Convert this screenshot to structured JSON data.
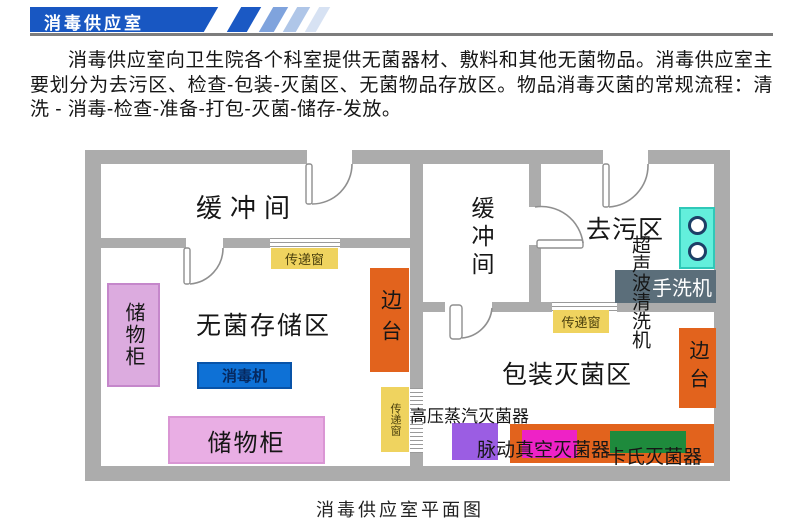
{
  "header": {
    "banner_title": "消毒供应室",
    "banner_color": "#1857C2",
    "stripe_colors": [
      "#1B59C4",
      "#7FA3DD",
      "#AFC6E8",
      "#D7E2F3"
    ]
  },
  "intro": {
    "text": "消毒供应室向卫生院各个科室提供无菌器材、敷料和其他无菌物品。消毒供应室主要划分为去污区、检查-包装-灭菌区、无菌物品存放区。物品消毒灭菌的常规流程：清洗 - 消毒-检查-准备-打包-灭菌-储存-发放。"
  },
  "floor_plan": {
    "caption": "消毒供应室平面图",
    "wall_color": "#ACACAC",
    "rooms": {
      "buffer_left": "缓冲间",
      "sterile_storage": "无菌存储区",
      "buffer_right": "缓冲间",
      "decontamination": "去污区",
      "packing_sterilization": "包装灭菌区"
    },
    "items": {
      "cabinet_left": {
        "label": "储物柜",
        "color": "#DCABDF"
      },
      "cabinet_bottom": {
        "label": "储物柜",
        "color": "#E9AEE4"
      },
      "disinfector": {
        "label": "消毒机",
        "color": "#0E71D6"
      },
      "side_table_left": {
        "label": "边台",
        "color": "#E2631D"
      },
      "side_table_right": {
        "label": "边台",
        "color": "#E2631D"
      },
      "pass_window_top": {
        "label": "传递窗",
        "color": "#EFD35F"
      },
      "pass_window_mid": {
        "label": "传递窗",
        "color": "#EFD35F"
      },
      "pass_window_right": {
        "label": "传递窗",
        "color": "#EFD35F"
      },
      "ultrasonic_cleaner": {
        "label": "超声波清洗机"
      },
      "hand_washer": {
        "label": "手洗机",
        "color": "#5B6E7A"
      },
      "sink": {
        "color": "#63EFDC"
      },
      "autoclave": {
        "label": "高压蒸汽灭菌器",
        "color": "#9B5DE3"
      },
      "sterilizer_counter": {
        "color": "#E2631D"
      },
      "pulse_vacuum_sterilizer": {
        "label": "脉动真空灭菌器",
        "color": "#EE22C6"
      },
      "cassette_sterilizer": {
        "label": "卡氏灭菌器",
        "color": "#1E8A3C"
      }
    }
  }
}
